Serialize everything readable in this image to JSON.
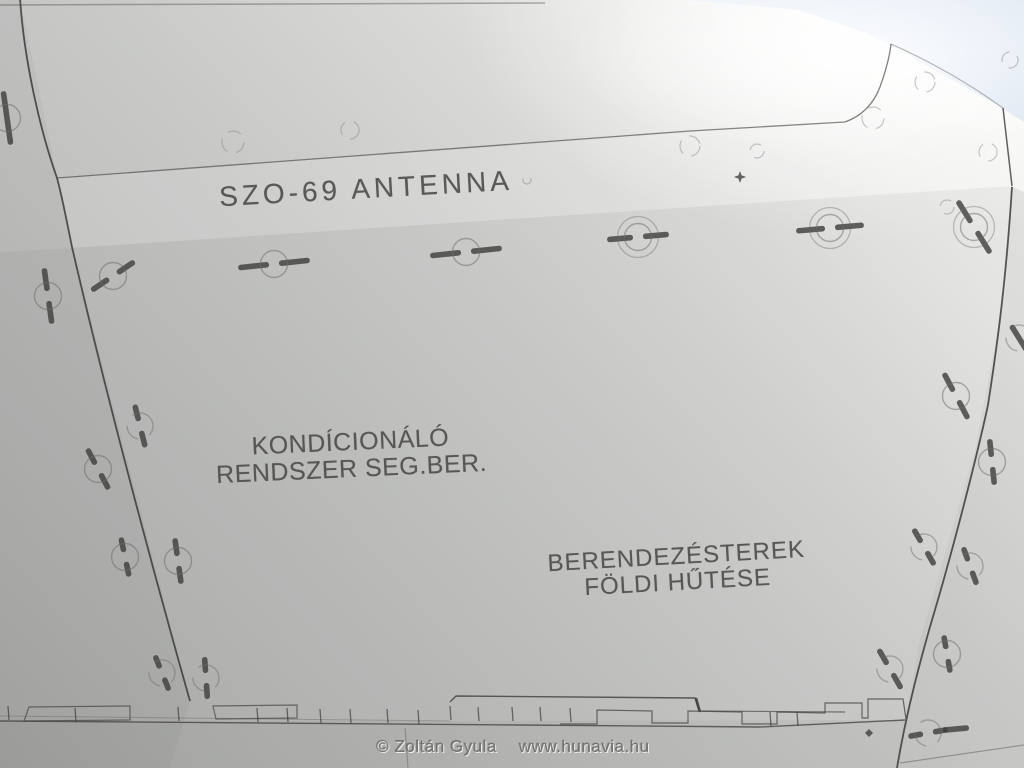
{
  "image": {
    "description": "Photograph of a light grey aircraft fuselage access panel seen from below, with Hungarian stencil markings, panel seam lines, circled quick-release fasteners and a hinged strip along the bottom edge; bright sky visible at the top-right corner."
  },
  "markings": {
    "antenna_label": "SZO-69 ANTENNA",
    "panel_label_line1": "KONDÍCIONÁLÓ",
    "panel_label_line2": "RENDSZER SEG.BER.",
    "bay_label_line1": "BERENDEZÉSTEREK",
    "bay_label_line2": "FÖLDI HŰTÉSE"
  },
  "watermark": {
    "author": "© Zoltán Gyula",
    "site": "www.hunavia.hu"
  },
  "colors": {
    "panel_bright": "#fbfbf9",
    "panel_mid": "#c9cac8",
    "panel_dark": "#abacaa",
    "sky": "#d9e3f1",
    "seam": "#3b3b39",
    "stencil_text": "#4c4c4a",
    "fastener_mark": "#403f3d"
  },
  "figure": {
    "fasteners": [
      [
        113,
        276,
        -34,
        52,
        "single",
        true
      ],
      [
        274,
        264,
        -6,
        72,
        "single",
        true
      ],
      [
        466,
        252,
        -6,
        72,
        "single",
        true
      ],
      [
        638,
        237,
        -5,
        62,
        "double",
        true
      ],
      [
        830,
        228,
        -5,
        68,
        "double",
        true
      ],
      [
        974,
        227,
        58,
        62,
        "double",
        true
      ],
      [
        7,
        118,
        82,
        54,
        "single",
        false
      ],
      [
        48,
        296,
        82,
        56,
        "single",
        true
      ],
      [
        98,
        469,
        62,
        46,
        "single",
        true
      ],
      [
        125,
        557,
        78,
        40,
        "single",
        true
      ],
      [
        162,
        673,
        68,
        38,
        "arc",
        true
      ],
      [
        140,
        426,
        76,
        44,
        "arc",
        true
      ],
      [
        178,
        561,
        82,
        46,
        "single",
        true
      ],
      [
        206,
        678,
        86,
        42,
        "arc",
        true
      ],
      [
        890,
        669,
        60,
        46,
        "arc",
        true
      ],
      [
        956,
        396,
        62,
        52,
        "single",
        true
      ],
      [
        924,
        547,
        60,
        42,
        "arc",
        true
      ],
      [
        992,
        462,
        84,
        46,
        "single",
        true
      ],
      [
        970,
        566,
        70,
        40,
        "arc",
        true
      ],
      [
        947,
        654,
        80,
        38,
        "single",
        true
      ],
      [
        1019,
        338,
        58,
        30,
        "arc",
        false
      ],
      [
        928,
        733,
        -10,
        40,
        "arc",
        true
      ],
      [
        956,
        729,
        -5,
        26,
        "none",
        false
      ]
    ],
    "dimples": [
      [
        233,
        142,
        11
      ],
      [
        350,
        130,
        9
      ],
      [
        690,
        146,
        10
      ],
      [
        757,
        151,
        7
      ],
      [
        925,
        82,
        10
      ],
      [
        988,
        152,
        9
      ],
      [
        873,
        118,
        11
      ],
      [
        1010,
        60,
        8
      ],
      [
        947,
        207,
        7
      ],
      [
        527,
        180,
        4
      ]
    ],
    "hinge_ticks": [
      [
        8,
        706
      ],
      [
        75,
        708
      ],
      [
        178,
        707
      ],
      [
        257,
        708
      ],
      [
        287,
        708
      ],
      [
        320,
        709
      ],
      [
        350,
        709
      ],
      [
        387,
        709
      ],
      [
        418,
        710
      ],
      [
        450,
        706
      ],
      [
        478,
        707
      ],
      [
        512,
        707
      ],
      [
        540,
        707
      ],
      [
        570,
        708
      ],
      [
        770,
        712
      ],
      [
        797,
        712
      ]
    ]
  }
}
